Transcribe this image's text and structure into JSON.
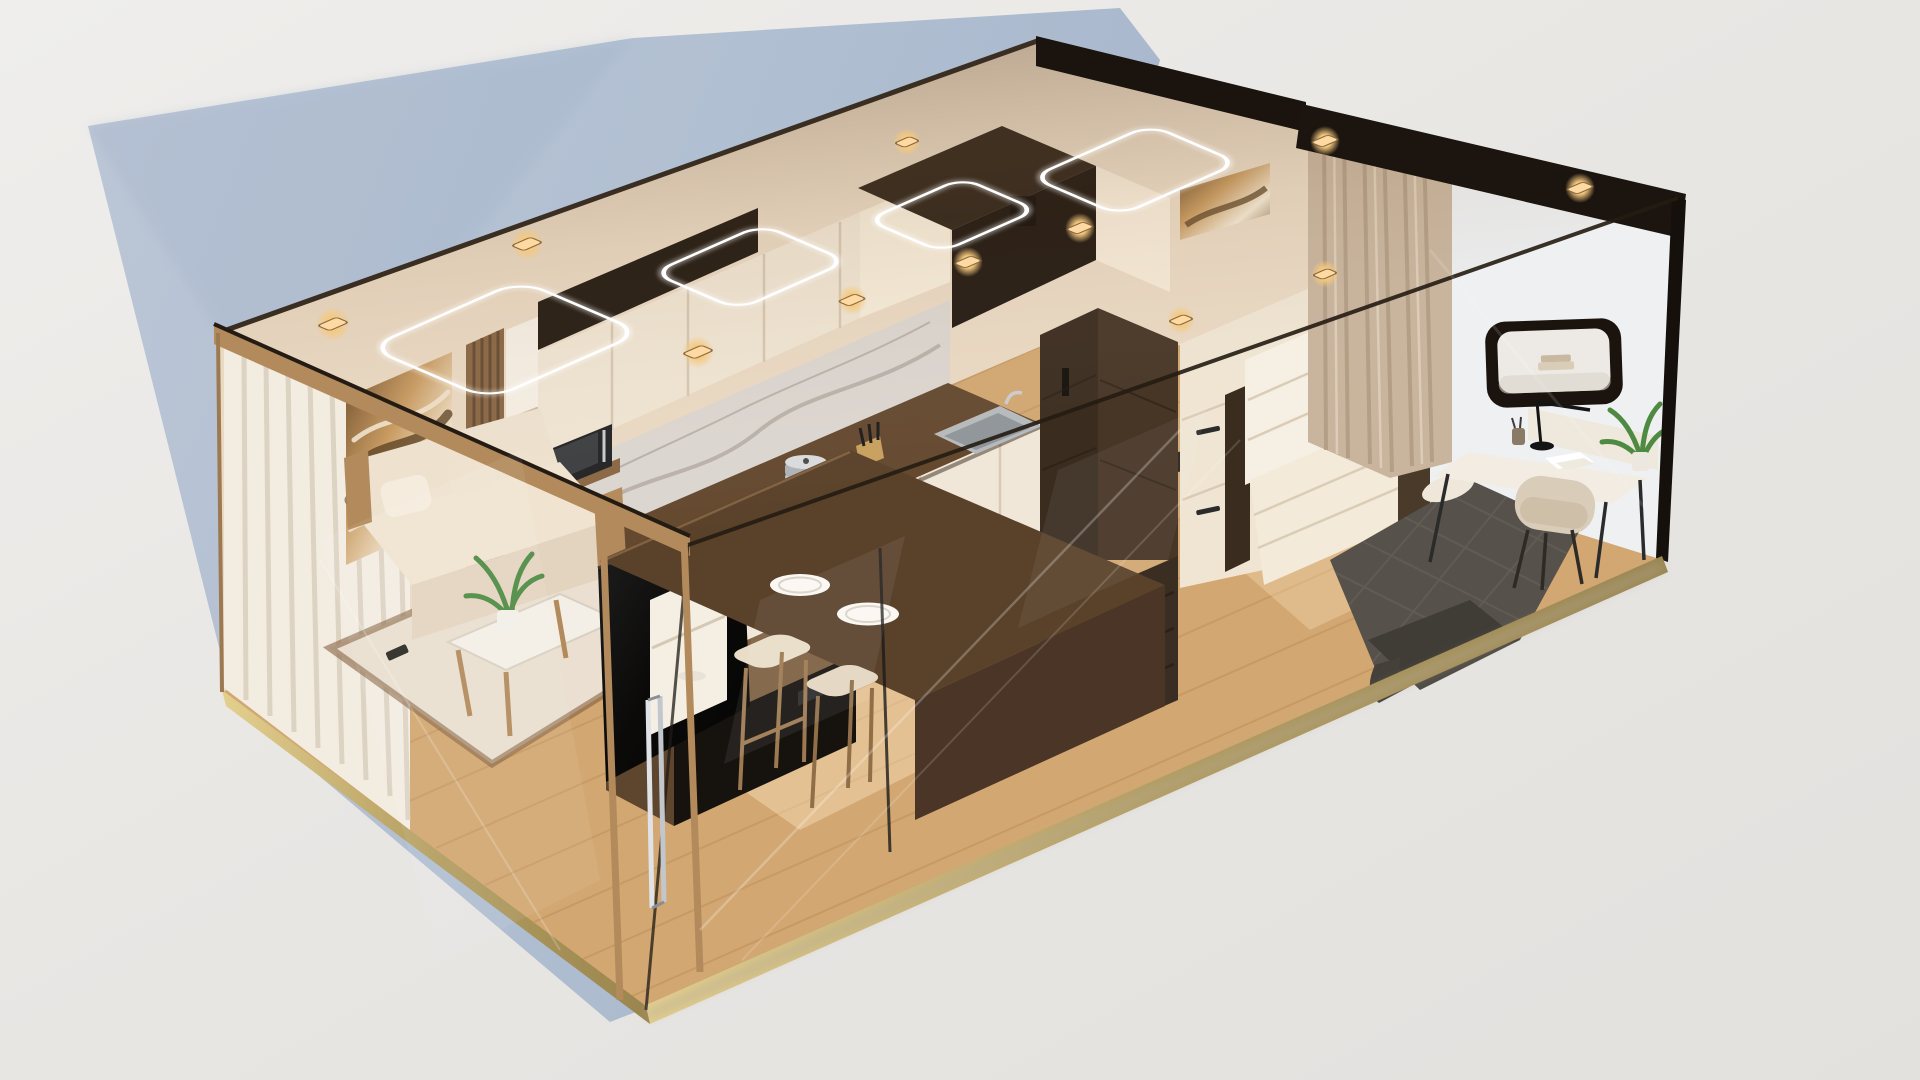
{
  "scene": {
    "type": "3d-isometric-interior-render",
    "description": "Cutaway isometric render of a compact glass-walled studio apartment module floating on a light gray studio backdrop",
    "rooms": [
      {
        "name": "living-area",
        "items": [
          "white-sheer-curtains",
          "gold-marble-wall-art",
          "wood-slat-accent",
          "cream-sofa",
          "throw-pillows",
          "coffee-table",
          "potted-plant",
          "remote-control",
          "area-rug",
          "tv",
          "media-console",
          "glass-door",
          "chrome-door-handle"
        ]
      },
      {
        "name": "kitchen",
        "items": [
          "upper-cabinets",
          "marble-backsplash",
          "dark-wood-countertop",
          "white-base-cabinets",
          "gas-cooktop",
          "cooking-pot",
          "stainless-sink",
          "knife-block",
          "microwave",
          "wood-shelf",
          "breakfast-bar",
          "dinner-plates",
          "bar-stools",
          "open-shelf-unit"
        ]
      },
      {
        "name": "utility-core",
        "items": [
          "dark-wood-fridge-column",
          "built-in-appliance-stack",
          "appliance-handles",
          "dark-soffit-volume"
        ]
      },
      {
        "name": "sleeping-area",
        "items": [
          "white-wardrobe",
          "fold-down-panel",
          "quilted-bed",
          "pillow",
          "beige-curtain",
          "small-wall-art"
        ]
      },
      {
        "name": "workspace",
        "items": [
          "wall-mounted-rounded-shelf",
          "books",
          "desk",
          "desk-lamp",
          "pen-cup",
          "papers",
          "desk-chair",
          "potted-plant"
        ]
      }
    ],
    "lighting": {
      "led_ring_lights": 4,
      "recessed_spotlights": 11,
      "style": "warm"
    },
    "exterior": {
      "ground": "light gray seamless backdrop",
      "cast_shadow": "soft blue-gray shadow falling to the lower left and behind the unit",
      "frame": "black glass frame on right end with brass floor edge trim"
    },
    "counts": {
      "plates": 2,
      "bar_stools": 2,
      "sofa_pillows": 2,
      "books_on_shelf": 2,
      "glass_walls": 3
    },
    "palette": {
      "bg": "#e8e6e3",
      "bg_light": "#f0efed",
      "shadow_blue": "#aebdd1",
      "shadow_wall": "#b7c4d6",
      "wall_cream": "#ead9c3",
      "wall_bright": "#f6ead7",
      "floor": "#d2a772",
      "floor_line": "#b4854f",
      "rug": "#eadfd0",
      "rug_border": "#7c5835",
      "wood_tan": "#b38a5c",
      "wood_mid": "#8a6744",
      "wood_dark": "#5d4531",
      "wood_espresso": "#3a2c1f",
      "soffit": "#241b12",
      "counter": "#64492f",
      "bar": "#5a412a",
      "marble": "#dcd6d0",
      "marble_vein": "#a49b92",
      "cream_cab": "#f0e5d3",
      "white_warm": "#f6efe4",
      "steel": "#b7babc",
      "black": "#16120e",
      "tv": "#0b0a09",
      "sofa": "#eee2cf",
      "pillow": "#f5ecdd",
      "curtain_left": "#f3ece1",
      "curtain_left_shade": "#d8cdbc",
      "curtain_right": "#c9b59e",
      "curtain_right_shade": "#a8927a",
      "bed": "#56514a",
      "bed_dark": "#3e3a34",
      "chair": "#d9ccb8",
      "desk": "#f2ece2",
      "brass": "#cdb878",
      "frame": "#1b140e",
      "led": "#ffffff",
      "spot": "#ffd9a2",
      "art_base": "#8a6a44",
      "plant": "#4e8a42",
      "plant_dark": "#35662c"
    }
  }
}
